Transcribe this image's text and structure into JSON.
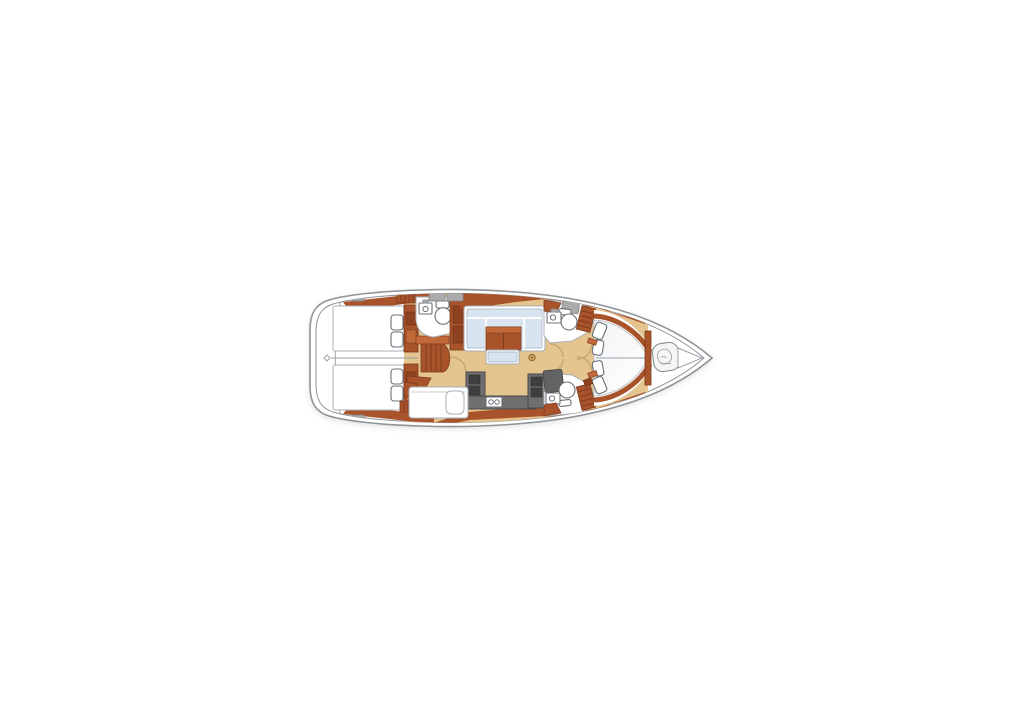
{
  "meta": {
    "title": "Sailboat interior layout floor plan, top-down view, bow pointing right",
    "view": "overhead deck plan",
    "orientation": "bow-right"
  },
  "colors": {
    "background": "#ffffff",
    "hull_outline": "#8e9398",
    "line_gray": "#9aa0a6",
    "wood": "#a9532b",
    "wood_dark": "#7a3a1e",
    "wood_light": "#c2693a",
    "wood_inset": "#8e421f",
    "wood_inset_dark": "#6e2f12",
    "floor": "#e4c48f",
    "floor_shade": "#c8a66b",
    "upholstery": "#d9e4f1",
    "upholstery_edge": "#9fb0c4",
    "counter": "#6f6f6f",
    "counter_edge": "#494949",
    "unit_dark": "#3f3f3f",
    "shower": "#636363",
    "fixture_edge": "#6b7075",
    "furn_edge": "#a9b0b8",
    "hatch": "#ababab",
    "hatch_edge": "#828282",
    "bed_shade": "#eef0f3"
  },
  "plan": {
    "areas": [
      {
        "id": "stern-platform",
        "label": "stern transom locker"
      },
      {
        "id": "aft-cabin-port",
        "label": "aft double cabin with berth and pillows"
      },
      {
        "id": "aft-cabin-starboard",
        "label": "aft double cabin with berth and pillows"
      },
      {
        "id": "companionway",
        "label": "companionway steps"
      },
      {
        "id": "aft-head",
        "label": "aft head with toilet and sink"
      },
      {
        "id": "saloon",
        "label": "saloon with U-settee, table and bench"
      },
      {
        "id": "galley",
        "label": "galley with twin sinks, stove units and counters"
      },
      {
        "id": "side-berth",
        "label": "bench seat with lift lid"
      },
      {
        "id": "fwd-head-port",
        "label": "forward head with toilet, sink and shower"
      },
      {
        "id": "fwd-head-starboard",
        "label": "forward head with toilet, sink and shower"
      },
      {
        "id": "owners-cabin",
        "label": "forward cabin with V-berth, pillows and side shelves"
      },
      {
        "id": "bow-locker",
        "label": "bow locker with windlass / sail bag"
      }
    ]
  }
}
